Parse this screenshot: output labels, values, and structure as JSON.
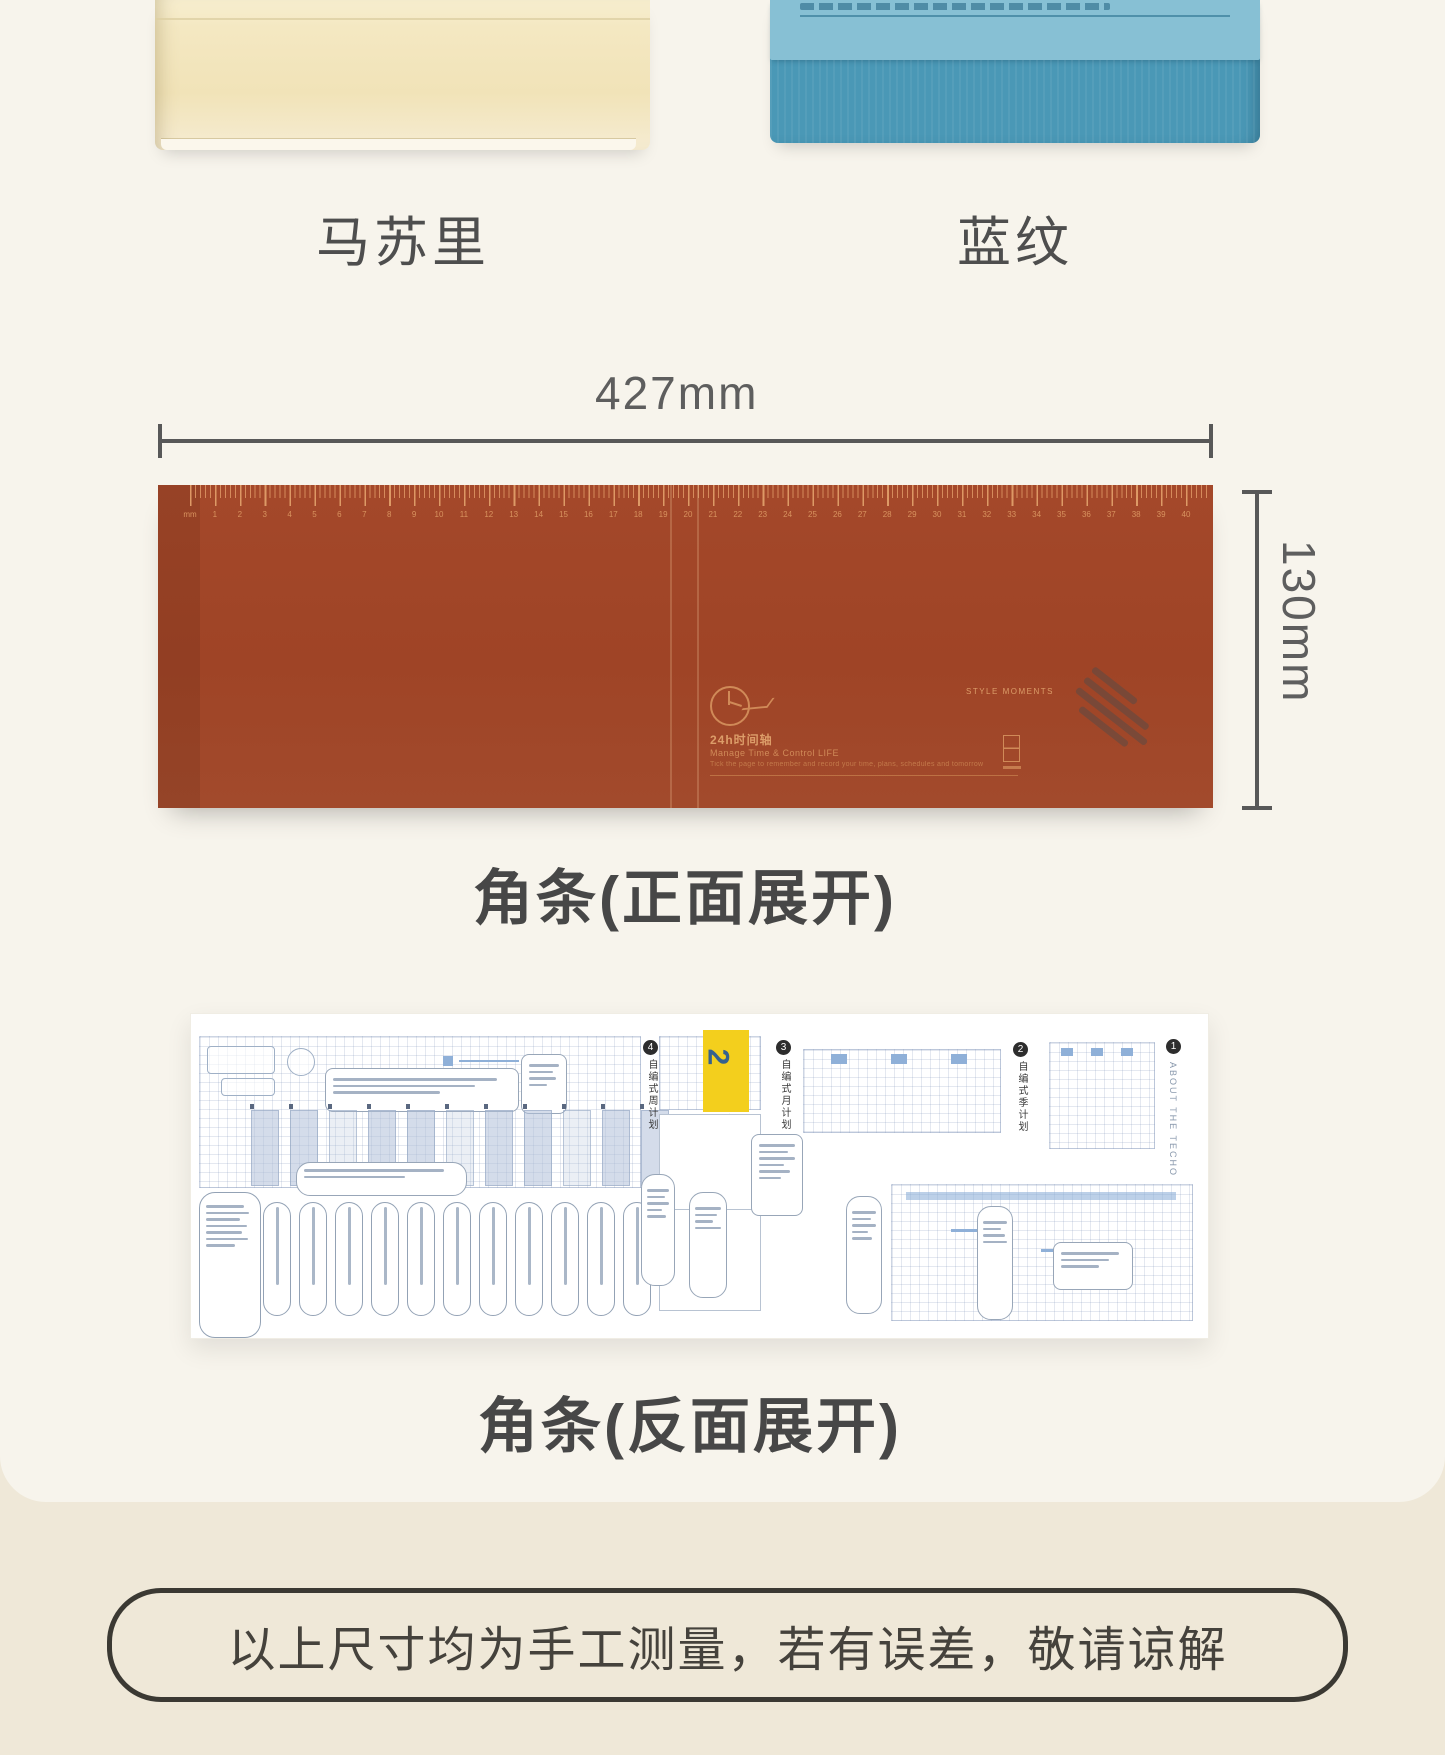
{
  "products": [
    {
      "label": "马苏里"
    },
    {
      "label": "蓝纹"
    }
  ],
  "dimension": {
    "width": "427mm",
    "height": "130mm"
  },
  "front_strip": {
    "caption": "角条(正面展开)",
    "ruler": {
      "unit": "mm",
      "max": 40
    },
    "print": {
      "title": "24h时间轴",
      "subtitle": "Manage Time & Control LIFE",
      "note": "Tick the page to remember and record your time, plans, schedules and tomorrow",
      "brand": "STYLE MOMENTS"
    }
  },
  "back_strip": {
    "caption": "角条(反面展开)",
    "tab_number": "2",
    "about": "ABOUT THE TECHO",
    "badges": [
      {
        "num": "4",
        "label": "自编式周计划"
      },
      {
        "num": "3",
        "label": "自编式月计划"
      },
      {
        "num": "2",
        "label": "自编式季计划"
      },
      {
        "num": "1",
        "label": "关于这本手帐"
      }
    ]
  },
  "footer": {
    "note": "以上尺寸均为手工测量，若有误差，敬请谅解"
  },
  "colors": {
    "strip_red": "#a04527",
    "ruler_ink": "#d8935f",
    "blue_flap": "#87c0d4",
    "blue_body": "#4a98b6",
    "cream": "#f3e7c1",
    "accent_yellow": "#f3cf1d",
    "page_top": "#f7f4ec",
    "page_bottom": "#efe8d8"
  }
}
